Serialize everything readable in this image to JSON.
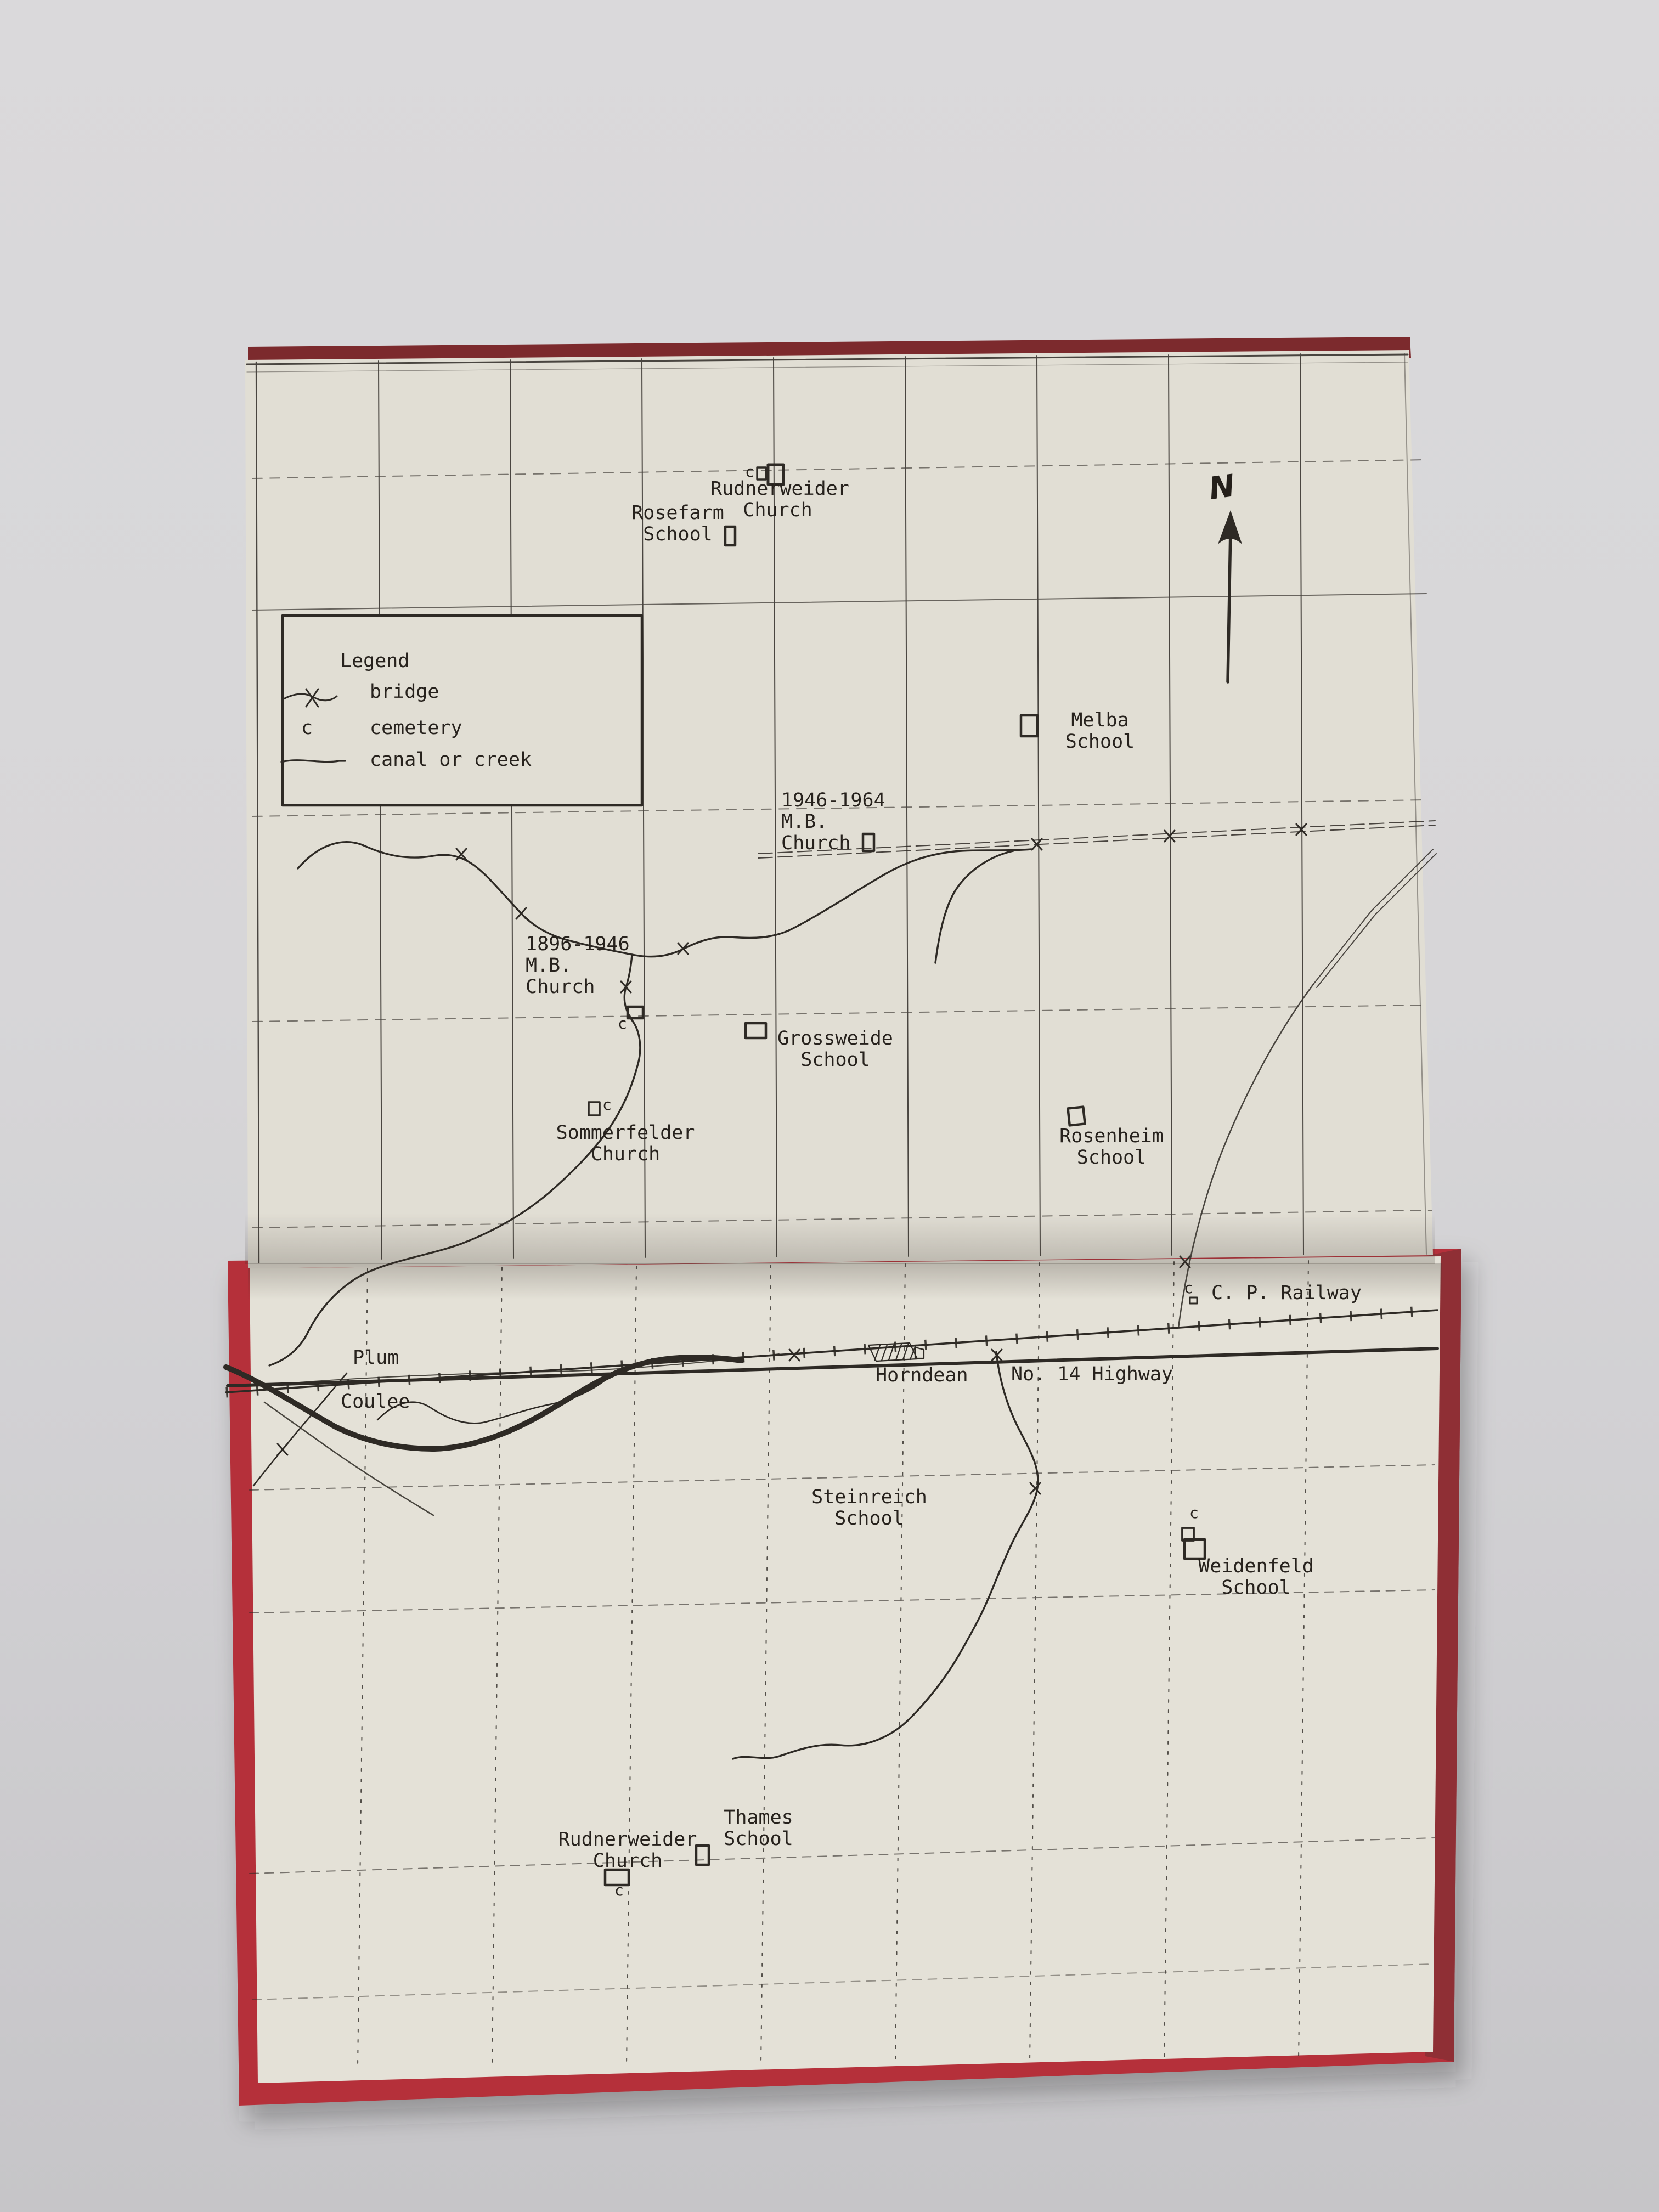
{
  "colors": {
    "cover_red": "#b23340",
    "cover_red_dark": "#8f2f35",
    "page": "#e1ded4",
    "ink": "#2e2a25",
    "wall": "#d7d6d8"
  },
  "legend": {
    "title": "Legend",
    "items": [
      {
        "symbol": "bridge-symbol",
        "label": "bridge"
      },
      {
        "symbol": "c",
        "label": "cemetery"
      },
      {
        "symbol": "canal-line",
        "label": "canal or creek"
      }
    ]
  },
  "compass": {
    "north_label": "N"
  },
  "markers": {
    "cemetery": "c"
  },
  "labels": {
    "rosefarm": "Rosefarm\nSchool",
    "rudnerweider_top": "Rudnerweider\nChurch",
    "melba": "Melba\nSchool",
    "mb_church_1946": "1946-1964\nM.B.\nChurch",
    "mb_church_1896": "1896-1946\nM.B.\nChurch",
    "grossweide": "Grossweide\nSchool",
    "sommerfelder": "Sommerfelder\nChurch",
    "rosenheim": "Rosenheim\nSchool",
    "cp_railway": "C. P. Railway",
    "no14_highway": "No. 14 Highway",
    "horndean": "Horndean",
    "plum": "Plum",
    "coulee": "Coulee",
    "steinreich": "Steinreich\nSchool",
    "weidenfeld": "Weidenfeld\nSchool",
    "thames": "Thames\nSchool",
    "rudnerweider_bottom": "Rudnerweider\nChurch"
  }
}
